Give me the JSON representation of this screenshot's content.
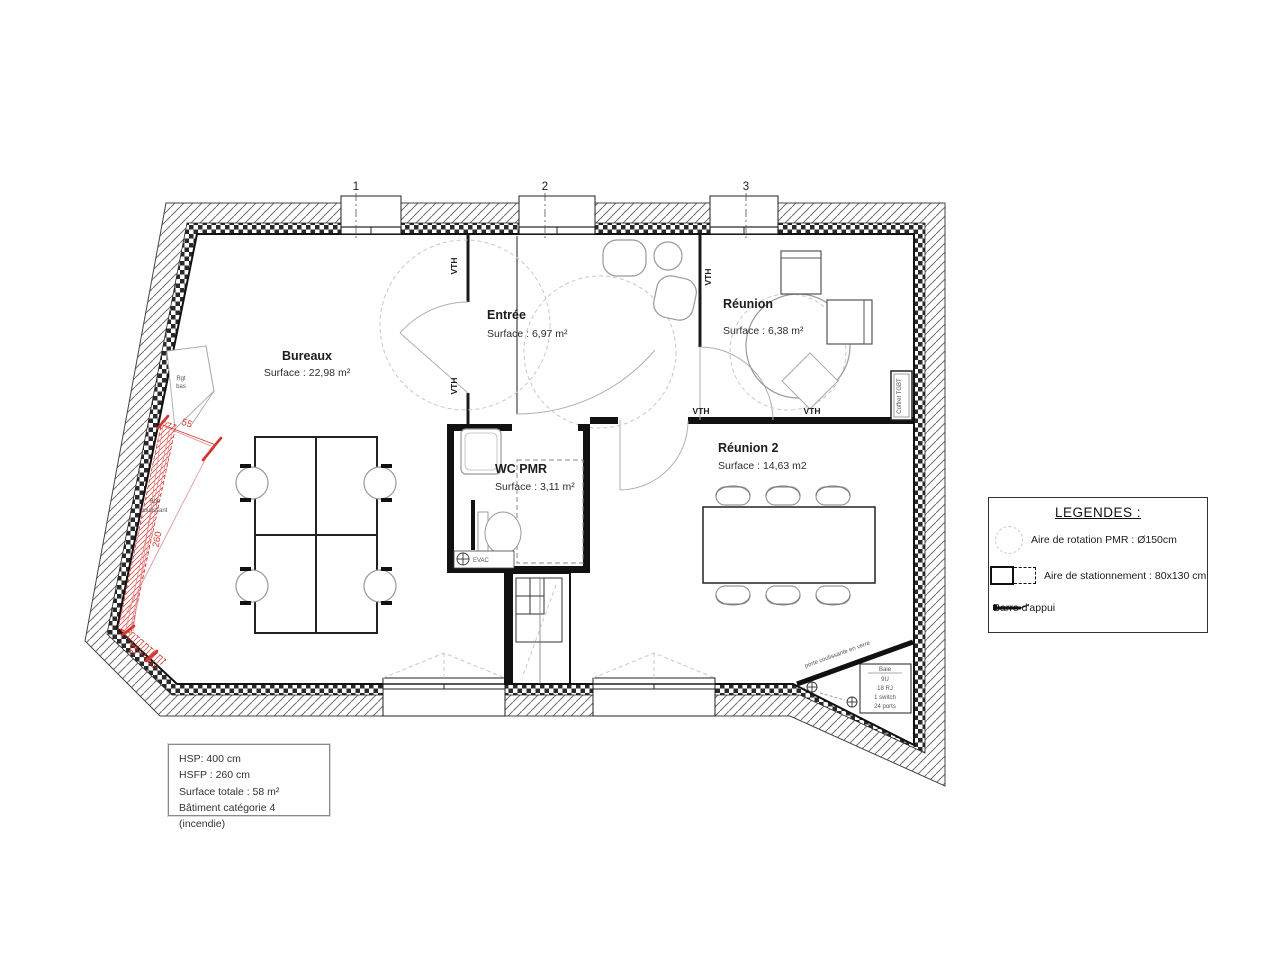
{
  "plan": {
    "grid_marks": [
      "1",
      "2",
      "3"
    ],
    "rooms": {
      "bureaux": {
        "name": "Bureaux",
        "surface": "Surface : 22,98 m²"
      },
      "entree": {
        "name": "Entrée",
        "surface": "Surface : 6,97 m²"
      },
      "reunion": {
        "name": "Réunion",
        "surface": "Surface : 6,38 m²"
      },
      "reunion2": {
        "name": "Réunion 2",
        "surface": "Surface : 14,63 m2"
      },
      "wc_pmr": {
        "name": "WC PMR",
        "surface": "Surface : 3,11 m²"
      }
    },
    "labels": {
      "vth": "VTH",
      "rgt": "Rgt",
      "bas": "bas",
      "coulissant": "coulissant",
      "evac": "EVAC",
      "coffret": "Coffret TGBT",
      "porte": "porte coulissante en verre"
    },
    "dimensions": {
      "d1": "55",
      "d2": "260",
      "d3": "22"
    },
    "baie": {
      "title": "Baie",
      "lines": [
        "9U",
        "18 RJ",
        "1 switch",
        "24 ports"
      ]
    }
  },
  "legend": {
    "title": "LEGENDES :",
    "items": [
      {
        "label": "Aire de rotation PMR : Ø150cm"
      },
      {
        "label": "Aire de stationnement : 80x130 cm"
      },
      {
        "label": "Barre d'appui"
      }
    ]
  },
  "info_box": {
    "lines": [
      "HSP: 400 cm",
      "HSFP : 260 cm",
      "Surface totale : 58 m²",
      "Bâtiment catégorie 4 (incendie)"
    ]
  },
  "colors": {
    "wall": "#1a1a1a",
    "accent_red": "#d4342c",
    "furniture_gray": "#9a9a9a"
  }
}
